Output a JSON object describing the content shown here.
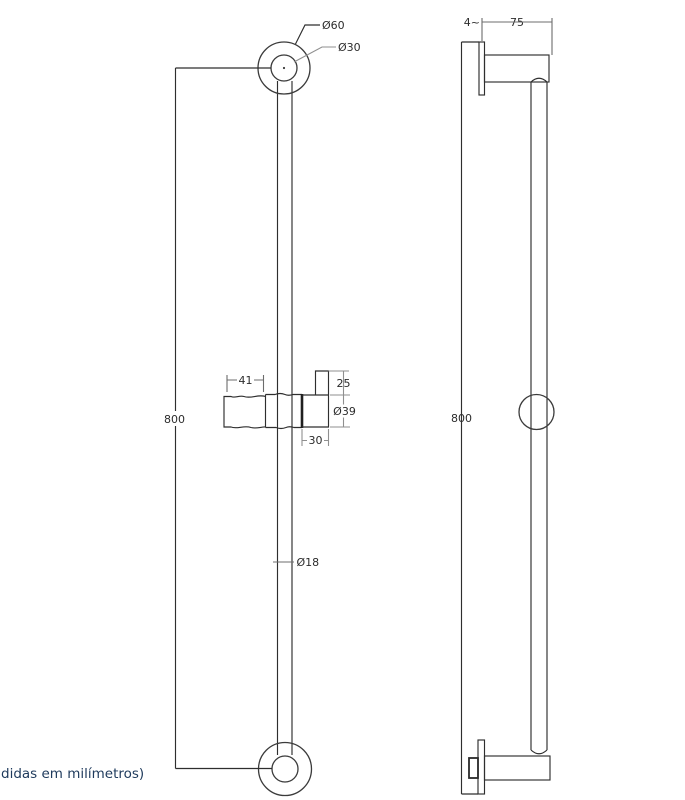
{
  "note": "didas em milímetros)",
  "front_view": {
    "labels": {
      "outer_diameter": "Ø60",
      "inner_diameter": "Ø30",
      "height": "800",
      "handle_length": "41",
      "holder_tab_height": "25",
      "holder_diameter": "Ø39",
      "holder_depth": "30",
      "bar_diameter": "Ø18"
    }
  },
  "side_view": {
    "labels": {
      "plate_thickness": "4~",
      "wall_projection": "75",
      "height": "800"
    }
  },
  "colors": {
    "object_line": "#3b3b3b",
    "dimension_line": "#8f8f8f",
    "dimension_text": "#2c2c2c",
    "note_text": "#1e3a5c",
    "background": "#ffffff"
  }
}
